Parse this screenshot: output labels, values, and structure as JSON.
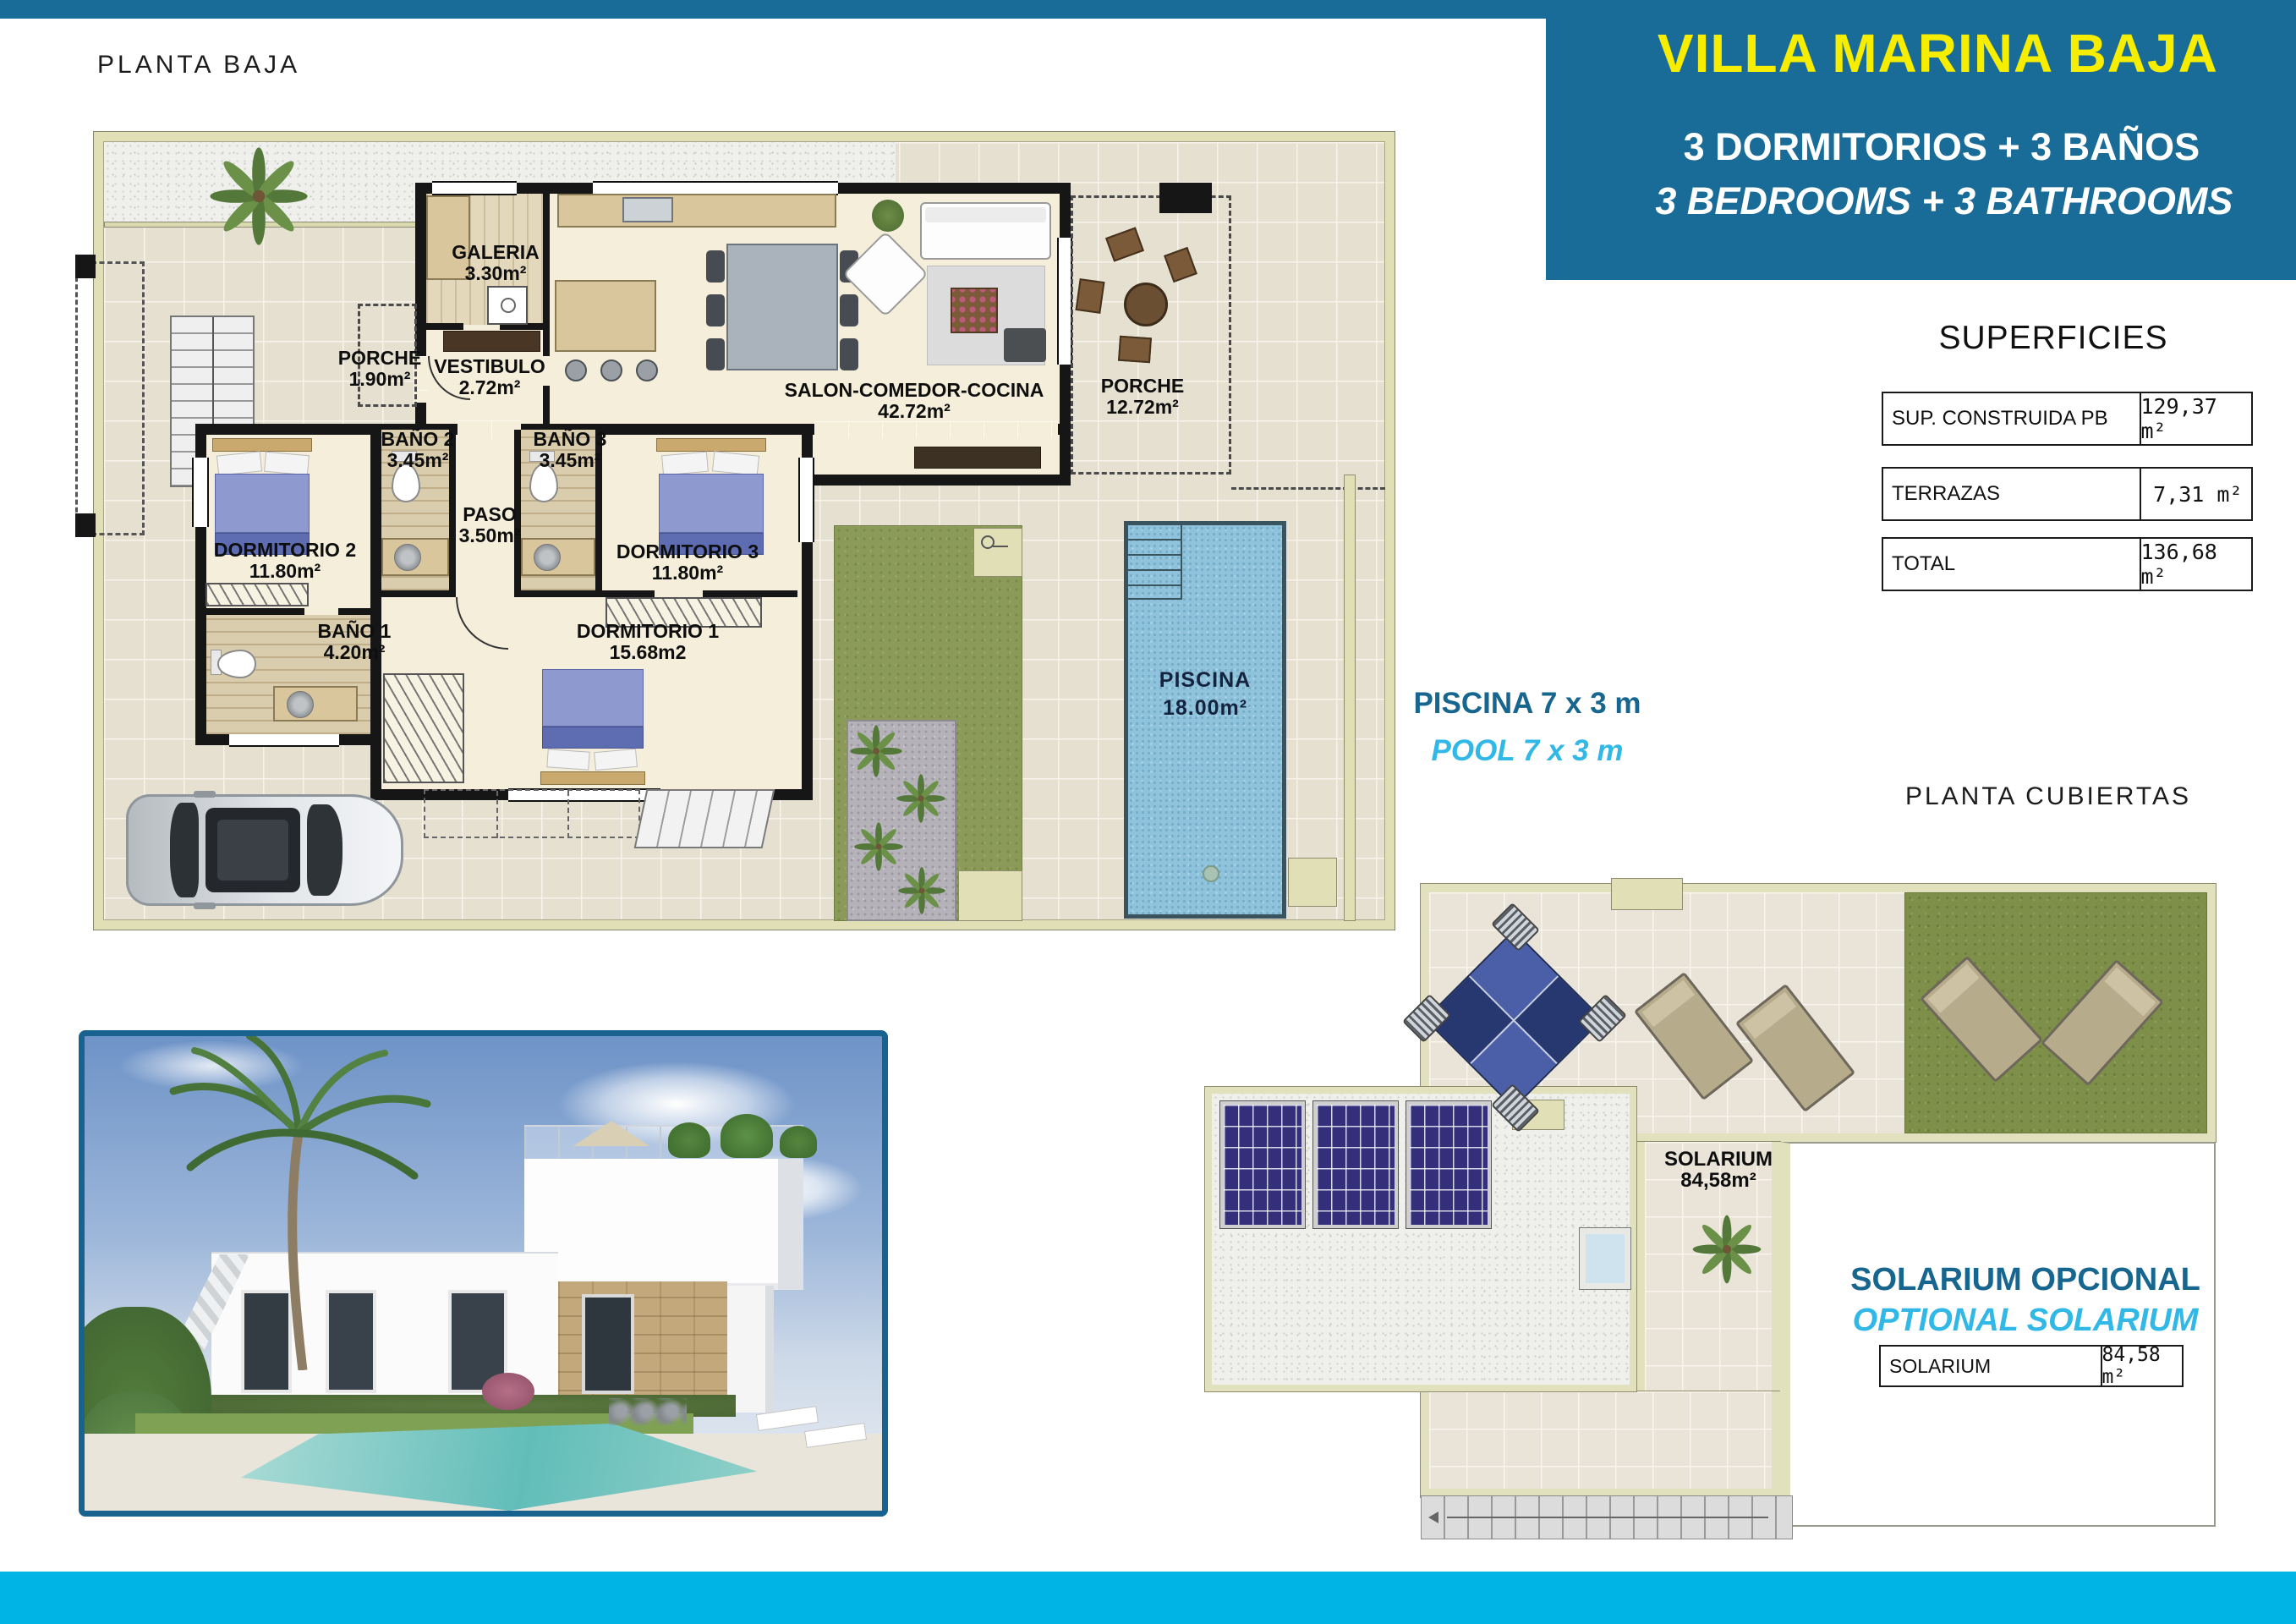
{
  "page": {
    "floor_label": "PLANTA BAJA",
    "roof_label": "PLANTA CUBIERTAS",
    "accent_blue": "#1a6c98",
    "accent_cyan_bar": "#00b4e6",
    "accent_lightblue": "#31b8e6",
    "title_yellow": "#f7ed00"
  },
  "header": {
    "title": "VILLA MARINA BAJA",
    "subtitle_es": "3 DORMITORIOS + 3 BAÑOS",
    "subtitle_en": "3 BEDROOMS + 3 BATHROOMS"
  },
  "superficies": {
    "title": "SUPERFICIES",
    "rows": [
      {
        "label": "SUP. CONSTRUIDA PB",
        "value": "129,37 m²"
      },
      {
        "label": "TERRAZAS",
        "value": "7,31 m²"
      },
      {
        "label": "TOTAL",
        "value": "136,68 m²"
      }
    ]
  },
  "pool_note": {
    "es": "PISCINA 7 x 3 m",
    "en": "POOL 7 x 3 m"
  },
  "solarium_note": {
    "es": "SOLARIUM OPCIONAL",
    "en": "OPTIONAL SOLARIUM"
  },
  "solarium_table": {
    "label": "SOLARIUM",
    "value": "84,58 m²"
  },
  "floorplan": {
    "rooms": [
      {
        "name": "GALERIA",
        "area": "3.30m²"
      },
      {
        "name": "PORCHE",
        "area": "1.90m²"
      },
      {
        "name": "VESTIBULO",
        "area": "2.72m²"
      },
      {
        "name": "SALON-COMEDOR-COCINA",
        "area": "42.72m²"
      },
      {
        "name": "PORCHE",
        "area": "12.72m²"
      },
      {
        "name": "BAÑO 2",
        "area": "3.45m²"
      },
      {
        "name": "BAÑO 3",
        "area": "3.45m²"
      },
      {
        "name": "PASO",
        "area": "3.50m²"
      },
      {
        "name": "DORMITORIO 2",
        "area": "11.80m²"
      },
      {
        "name": "DORMITORIO 3",
        "area": "11.80m²"
      },
      {
        "name": "BAÑO 1",
        "area": "4.20m²"
      },
      {
        "name": "DORMITORIO 1",
        "area": "15.68m2"
      }
    ],
    "pool": {
      "name": "PISCINA",
      "area": "18.00m²"
    }
  },
  "roofplan": {
    "room_name": "SOLARIUM",
    "room_area": "84,58m²"
  }
}
